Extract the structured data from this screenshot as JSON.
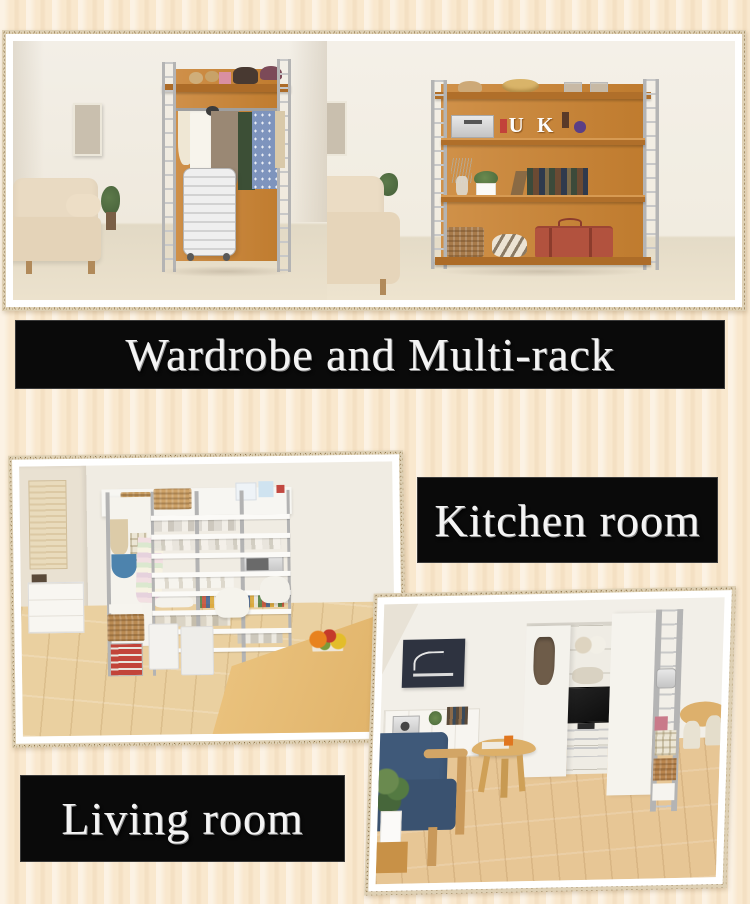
{
  "page": {
    "width": 750,
    "height": 904,
    "background_color": "#f9e8ce"
  },
  "banners": {
    "hero": {
      "label": "Wardrobe and Multi-rack",
      "bg": "#0a0a0a",
      "text_color": "#f4f4f4"
    },
    "kitchen": {
      "label": "Kitchen room",
      "bg": "#0a0a0a",
      "text_color": "#f4f4f4"
    },
    "living": {
      "label": "Living room",
      "bg": "#0a0a0a",
      "text_color": "#f4f4f4"
    }
  },
  "photos": {
    "wardrobe": {
      "name": "wardrobe-room-photo"
    },
    "multirack": {
      "name": "multi-rack-room-photo"
    },
    "kitchen": {
      "name": "kitchen-room-photo"
    },
    "living": {
      "name": "living-room-photo"
    }
  },
  "decor": {
    "shelf_letters": "U K"
  },
  "colors": {
    "rack_orange": "#c9883d",
    "shelf_front": "#ad6c28",
    "metal_frame": "#b4b4b4",
    "wood_floor": "#e8cb99",
    "sofa_navy": "#3f5979",
    "sofa_beige": "#e9dac2",
    "photo_border": "#ffffff",
    "speckle_border": "#ded0b4"
  }
}
